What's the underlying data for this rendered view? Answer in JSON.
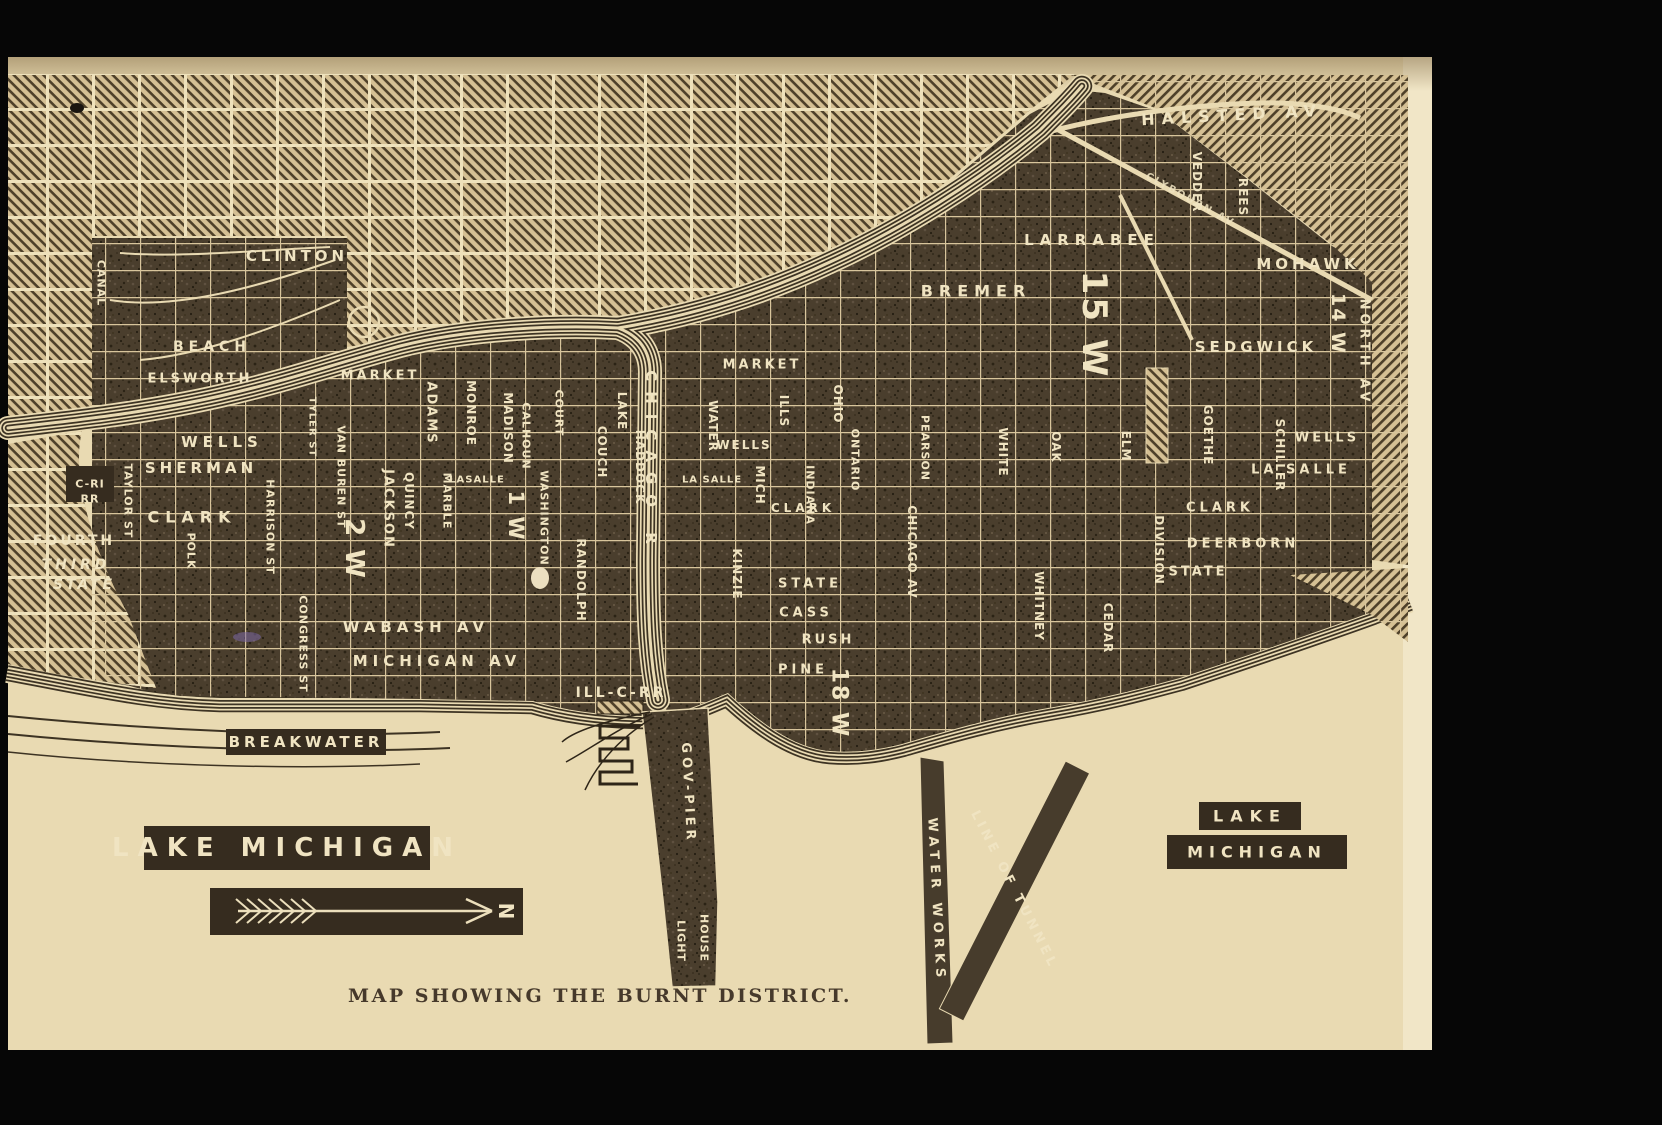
{
  "caption": "MAP SHOWING THE BURNT DISTRICT.",
  "map": {
    "colors": {
      "frame_black": "#060606",
      "paper": "#e9dab2",
      "paper_margin": "#f1e6c7",
      "burnt_base": "#4a3e2d",
      "hatch_line": "#4e4029",
      "street_line": "#d8c59c",
      "river_dark": "#3d3323",
      "plaque": "#362c1f",
      "ink_light": "#f0e4c2",
      "caption_ink": "#46392b"
    },
    "compass": {
      "direction_label": "N"
    },
    "water_labels": [
      "LAKE MICHIGAN",
      "LAKE",
      "MICHIGAN",
      "BREAKWATER",
      "CHICAGO R"
    ],
    "labels": [
      {
        "n": "clinton",
        "t": "CLINTON",
        "x": 297,
        "y": 256,
        "s": 15,
        "sp": 4
      },
      {
        "n": "beach",
        "t": "BEACH",
        "x": 212,
        "y": 347,
        "s": 14,
        "sp": 5
      },
      {
        "n": "elsworth",
        "t": "ELSWORTH",
        "x": 200,
        "y": 379,
        "s": 13,
        "sp": 3
      },
      {
        "n": "market-west",
        "t": "MARKET",
        "x": 380,
        "y": 376,
        "s": 13,
        "sp": 3
      },
      {
        "n": "wells-west",
        "t": "WELLS",
        "x": 222,
        "y": 442,
        "s": 15,
        "sp": 5
      },
      {
        "n": "sherman",
        "t": "SHERMAN",
        "x": 201,
        "y": 468,
        "s": 15,
        "sp": 4
      },
      {
        "n": "clark-west",
        "t": "CLARK",
        "x": 192,
        "y": 517,
        "s": 16,
        "sp": 6
      },
      {
        "n": "fourth",
        "t": "FOURTH",
        "x": 74,
        "y": 541,
        "s": 14,
        "sp": 3
      },
      {
        "n": "third",
        "t": "THIRD",
        "x": 76,
        "y": 565,
        "s": 14,
        "sp": 4,
        "it": 1
      },
      {
        "n": "state-west",
        "t": "STATE",
        "x": 84,
        "y": 585,
        "s": 14,
        "sp": 3,
        "it": 1
      },
      {
        "n": "c-ri-rr-1",
        "t": "C-RI",
        "x": 90,
        "y": 484,
        "s": 11,
        "sp": 1,
        "plq": [
          48,
          36
        ]
      },
      {
        "n": "c-ri-rr-2",
        "t": "RR",
        "x": 90,
        "y": 499,
        "s": 11,
        "sp": 1
      },
      {
        "n": "wabash-av",
        "t": "WABASH AV",
        "x": 416,
        "y": 627,
        "s": 15,
        "sp": 5
      },
      {
        "n": "michigan-av",
        "t": "MICHIGAN AV",
        "x": 437,
        "y": 661,
        "s": 15,
        "sp": 5
      },
      {
        "n": "canal",
        "t": "CANAL",
        "x": 101,
        "y": 283,
        "r": 90,
        "s": 11,
        "sp": 1
      },
      {
        "n": "taylor-st",
        "t": "TAYLOR ST",
        "x": 128,
        "y": 501,
        "r": 90,
        "s": 11,
        "sp": 1
      },
      {
        "n": "polk",
        "t": "POLK",
        "x": 191,
        "y": 551,
        "r": 90,
        "s": 11,
        "sp": 1
      },
      {
        "n": "harrison-st",
        "t": "HARRISON ST",
        "x": 270,
        "y": 527,
        "r": 90,
        "s": 11,
        "sp": 1
      },
      {
        "n": "van-buren-st",
        "t": "VAN BUREN ST",
        "x": 341,
        "y": 477,
        "r": 90,
        "s": 11,
        "sp": 1
      },
      {
        "n": "tyler-st",
        "t": "TYLER ST",
        "x": 312,
        "y": 427,
        "r": 90,
        "s": 10,
        "sp": 1
      },
      {
        "n": "congress-st",
        "t": "CONGRESS ST",
        "x": 303,
        "y": 644,
        "r": 90,
        "s": 11,
        "sp": 1
      },
      {
        "n": "jackson",
        "t": "JACKSON",
        "x": 388,
        "y": 509,
        "r": 90,
        "s": 13,
        "sp": 2
      },
      {
        "n": "quincy",
        "t": "QUINCY",
        "x": 409,
        "y": 501,
        "r": 90,
        "s": 12,
        "sp": 1
      },
      {
        "n": "ward-2",
        "t": "2 W",
        "x": 354,
        "y": 549,
        "r": 90,
        "s": 26,
        "sp": 2,
        "w": 700
      },
      {
        "n": "ward-1",
        "t": "1 W",
        "x": 516,
        "y": 516,
        "r": 90,
        "s": 21,
        "sp": 2,
        "w": 700
      },
      {
        "n": "adams",
        "t": "ADAMS",
        "x": 431,
        "y": 413,
        "r": 90,
        "s": 13,
        "sp": 2
      },
      {
        "n": "marble",
        "t": "MARBLE",
        "x": 447,
        "y": 501,
        "r": 90,
        "s": 11,
        "sp": 1
      },
      {
        "n": "monroe",
        "t": "MONROE",
        "x": 471,
        "y": 413,
        "r": 90,
        "s": 12,
        "sp": 1
      },
      {
        "n": "madison",
        "t": "MADISON",
        "x": 508,
        "y": 428,
        "r": 90,
        "s": 12,
        "sp": 1
      },
      {
        "n": "lasalle-south",
        "t": "LASALLE",
        "x": 477,
        "y": 480,
        "s": 10,
        "sp": 1
      },
      {
        "n": "calhoun",
        "t": "CALHOUN",
        "x": 526,
        "y": 436,
        "r": 90,
        "s": 11,
        "sp": 1
      },
      {
        "n": "washington",
        "t": "WASHINGTON",
        "x": 544,
        "y": 518,
        "r": 90,
        "s": 11,
        "sp": 1
      },
      {
        "n": "court",
        "t": "COURT",
        "x": 559,
        "y": 413,
        "r": 90,
        "s": 11,
        "sp": 1
      },
      {
        "n": "randolph",
        "t": "RANDOLPH",
        "x": 581,
        "y": 580,
        "r": 90,
        "s": 12,
        "sp": 1
      },
      {
        "n": "couch",
        "t": "COUCH",
        "x": 602,
        "y": 452,
        "r": 90,
        "s": 12,
        "sp": 1
      },
      {
        "n": "haddock",
        "t": "HADDOCK",
        "x": 640,
        "y": 467,
        "r": 90,
        "s": 12,
        "sp": 1
      },
      {
        "n": "lake-st",
        "t": "LAKE",
        "x": 622,
        "y": 411,
        "r": 90,
        "s": 12,
        "sp": 1
      },
      {
        "n": "chicago-river",
        "t": "CHICAGO R",
        "x": 651,
        "y": 462,
        "r": 90,
        "s": 15,
        "sp": 10
      },
      {
        "n": "ill-c-rr",
        "t": "ILL-C-RR",
        "x": 621,
        "y": 693,
        "s": 14,
        "sp": 3
      },
      {
        "n": "market-center",
        "t": "MARKET",
        "x": 762,
        "y": 365,
        "s": 13,
        "sp": 3
      },
      {
        "n": "wells-center",
        "t": "WELLS",
        "x": 744,
        "y": 445,
        "s": 12,
        "sp": 2
      },
      {
        "n": "lasalle-center",
        "t": "LA SALLE",
        "x": 712,
        "y": 480,
        "s": 10,
        "sp": 1
      },
      {
        "n": "clark-center",
        "t": "CLARK",
        "x": 803,
        "y": 508,
        "s": 12,
        "sp": 4
      },
      {
        "n": "water",
        "t": "WATER",
        "x": 713,
        "y": 426,
        "r": 90,
        "s": 12,
        "sp": 1
      },
      {
        "n": "mich",
        "t": "MICH",
        "x": 760,
        "y": 485,
        "r": 90,
        "s": 12,
        "sp": 1
      },
      {
        "n": "ills",
        "t": "ILLS",
        "x": 784,
        "y": 411,
        "r": 90,
        "s": 12,
        "sp": 1
      },
      {
        "n": "indiana",
        "t": "INDIANA",
        "x": 810,
        "y": 495,
        "r": 90,
        "s": 11,
        "sp": 1
      },
      {
        "n": "ontario",
        "t": "ONTARIO",
        "x": 855,
        "y": 460,
        "r": 90,
        "s": 11,
        "sp": 1
      },
      {
        "n": "ohio",
        "t": "OHIO",
        "x": 838,
        "y": 404,
        "r": 90,
        "s": 12,
        "sp": 1
      },
      {
        "n": "kinzie",
        "t": "KINZIE",
        "x": 737,
        "y": 574,
        "r": 90,
        "s": 12,
        "sp": 1
      },
      {
        "n": "state-center",
        "t": "STATE",
        "x": 810,
        "y": 584,
        "s": 13,
        "sp": 4
      },
      {
        "n": "cass",
        "t": "CASS",
        "x": 806,
        "y": 613,
        "s": 13,
        "sp": 4
      },
      {
        "n": "rush",
        "t": "RUSH",
        "x": 828,
        "y": 640,
        "s": 13,
        "sp": 3
      },
      {
        "n": "pine",
        "t": "PINE",
        "x": 803,
        "y": 670,
        "s": 13,
        "sp": 4
      },
      {
        "n": "ward-18",
        "t": "18 W",
        "x": 839,
        "y": 703,
        "r": 90,
        "s": 22,
        "sp": 2,
        "w": 700
      },
      {
        "n": "pearson",
        "t": "PEARSON",
        "x": 925,
        "y": 448,
        "r": 90,
        "s": 11,
        "sp": 1
      },
      {
        "n": "chicago-av",
        "t": "CHICAGO AV",
        "x": 912,
        "y": 552,
        "r": 90,
        "s": 12,
        "sp": 1
      },
      {
        "n": "white",
        "t": "WHITE",
        "x": 1003,
        "y": 452,
        "r": 90,
        "s": 12,
        "sp": 1
      },
      {
        "n": "oak",
        "t": "OAK",
        "x": 1056,
        "y": 447,
        "r": 90,
        "s": 12,
        "sp": 1
      },
      {
        "n": "elm",
        "t": "ELM",
        "x": 1126,
        "y": 446,
        "r": 90,
        "s": 12,
        "sp": 1
      },
      {
        "n": "division",
        "t": "DIVISION",
        "x": 1159,
        "y": 550,
        "r": 90,
        "s": 12,
        "sp": 1
      },
      {
        "n": "whitney",
        "t": "WHITNEY",
        "x": 1039,
        "y": 606,
        "r": 90,
        "s": 12,
        "sp": 1
      },
      {
        "n": "cedar",
        "t": "CEDAR",
        "x": 1108,
        "y": 628,
        "r": 90,
        "s": 12,
        "sp": 1
      },
      {
        "n": "goethe",
        "t": "GOETHE",
        "x": 1208,
        "y": 435,
        "r": 90,
        "s": 12,
        "sp": 1
      },
      {
        "n": "schiller",
        "t": "SCHILLER",
        "x": 1280,
        "y": 455,
        "r": 90,
        "s": 12,
        "sp": 1
      },
      {
        "n": "bremer",
        "t": "BREMER",
        "x": 976,
        "y": 291,
        "s": 16,
        "sp": 6
      },
      {
        "n": "larrabee",
        "t": "LARRABEE",
        "x": 1092,
        "y": 240,
        "s": 15,
        "sp": 6
      },
      {
        "n": "mohawk",
        "t": "MOHAWK",
        "x": 1308,
        "y": 264,
        "s": 15,
        "sp": 4
      },
      {
        "n": "sedgwick",
        "t": "SEDGWICK",
        "x": 1256,
        "y": 347,
        "s": 15,
        "sp": 4
      },
      {
        "n": "halsted-av",
        "t": "HALSTED AV",
        "x": 1232,
        "y": 115,
        "r": -3,
        "s": 16,
        "sp": 7
      },
      {
        "n": "vedder",
        "t": "VEDDER",
        "x": 1197,
        "y": 182,
        "r": 90,
        "s": 12,
        "sp": 1
      },
      {
        "n": "rees",
        "t": "REES",
        "x": 1243,
        "y": 197,
        "r": 90,
        "s": 12,
        "sp": 1
      },
      {
        "n": "clybourn-av",
        "t": "CLYBOURN AV",
        "x": 1190,
        "y": 200,
        "r": 29,
        "s": 10,
        "sp": 2,
        "o": 0.85
      },
      {
        "n": "ward-15",
        "t": "15 W",
        "x": 1094,
        "y": 325,
        "r": 90,
        "s": 34,
        "sp": 3,
        "w": 700
      },
      {
        "n": "ward-14",
        "t": "14 W",
        "x": 1338,
        "y": 324,
        "r": 90,
        "s": 19,
        "sp": 2,
        "w": 700
      },
      {
        "n": "north-av",
        "t": "NORTH AV",
        "x": 1364,
        "y": 352,
        "r": 90,
        "s": 13,
        "sp": 4
      },
      {
        "n": "wells-north",
        "t": "WELLS",
        "x": 1327,
        "y": 438,
        "s": 13,
        "sp": 3
      },
      {
        "n": "lasalle-north",
        "t": "LA SALLE",
        "x": 1301,
        "y": 470,
        "s": 13,
        "sp": 4
      },
      {
        "n": "clark-north",
        "t": "CLARK",
        "x": 1220,
        "y": 508,
        "s": 13,
        "sp": 4
      },
      {
        "n": "deerborn",
        "t": "DEERBORN",
        "x": 1243,
        "y": 544,
        "s": 13,
        "sp": 4
      },
      {
        "n": "state-north",
        "t": "STATE",
        "x": 1198,
        "y": 572,
        "s": 13,
        "sp": 3
      },
      {
        "n": "gov-pier",
        "t": "GOV-PIER",
        "x": 688,
        "y": 793,
        "r": 87,
        "s": 13,
        "sp": 4
      },
      {
        "n": "light",
        "t": "LIGHT",
        "x": 681,
        "y": 941,
        "r": 90,
        "s": 11,
        "sp": 1
      },
      {
        "n": "house",
        "t": "HOUSE",
        "x": 704,
        "y": 938,
        "r": 90,
        "s": 11,
        "sp": 1
      },
      {
        "n": "water-works",
        "t": "WATER WORKS",
        "x": 936,
        "y": 900,
        "r": 87,
        "s": 13,
        "sp": 5
      },
      {
        "n": "line-of-tunnel",
        "t": "LINE OF TUNNEL",
        "x": 1014,
        "y": 890,
        "r": 63,
        "s": 13,
        "sp": 4
      },
      {
        "n": "breakwater",
        "t": "BREAKWATER",
        "x": 306,
        "y": 742,
        "s": 15,
        "sp": 4,
        "plq": [
          160,
          26
        ]
      },
      {
        "n": "lake-michigan-sw",
        "t": "LAKE MICHIGAN",
        "x": 287,
        "y": 848,
        "s": 26,
        "sp": 9,
        "w": 700,
        "plq": [
          286,
          44
        ]
      },
      {
        "n": "lake-ne",
        "t": "LAKE",
        "x": 1250,
        "y": 816,
        "s": 16,
        "sp": 7,
        "plq": [
          102,
          28
        ]
      },
      {
        "n": "michigan-ne",
        "t": "MICHIGAN",
        "x": 1257,
        "y": 852,
        "s": 16,
        "sp": 6,
        "plq": [
          180,
          34
        ]
      },
      {
        "n": "compass-n",
        "t": "N",
        "x": 506,
        "y": 911,
        "r": 90,
        "s": 20,
        "sp": 0,
        "w": 700
      }
    ]
  }
}
